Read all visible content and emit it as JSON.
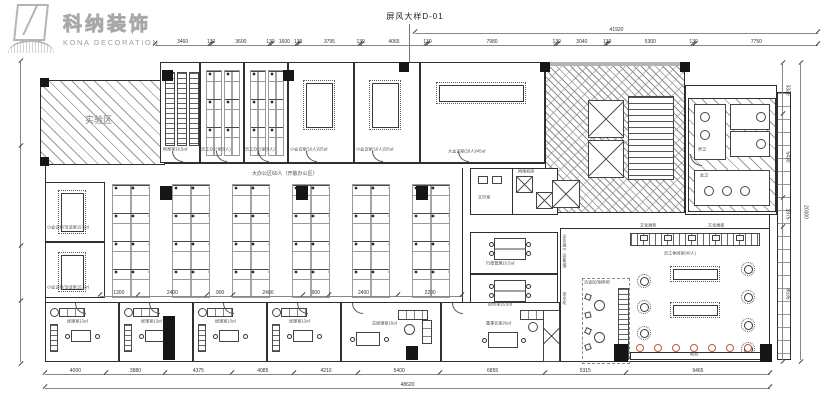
{
  "logo": {
    "cn": "科纳装饰",
    "en": "KONA DECORATION"
  },
  "title": "屏风大样D-01",
  "colors": {
    "stool_accent": "#c2573b",
    "logo_gray": "#b5b5b5",
    "line": "#2f2f2f"
  },
  "dims": {
    "top": [
      "3460",
      "130",
      "3600",
      "130",
      "1600",
      "130",
      "3795",
      "130",
      "4065",
      "130",
      "7980",
      "130",
      "3040",
      "130",
      "5300",
      "130",
      "7750"
    ],
    "top_overall": "41920",
    "bottom": [
      "4000",
      "3880",
      "4375",
      "4085",
      "4210",
      "5400",
      "6855",
      "5315",
      "9465"
    ],
    "bottom_overall": "48620",
    "right": [
      "3320",
      "5430",
      "1875",
      "8535"
    ],
    "right_overall": "20300",
    "office_inner": [
      "1300",
      "2400",
      "900",
      "2400",
      "900",
      "2400",
      "2200"
    ]
  },
  "rooms": {
    "lab": "实验区",
    "archive": "档案室16.5㎡",
    "staff_a": "员工办公室(8人)",
    "staff_b": "员工办公室(8人)",
    "meeting_a": "小会议室(10人)/25㎡",
    "meeting_b": "小会议室(10人)/25㎡",
    "conference": "大会议室(18人)/45㎡",
    "open_office": "大办公区60人（开敞办公区）",
    "left_meeting_1": "小会议室/洽谈室15.5㎡",
    "left_meeting_2": "小会议室/洽谈室15.5㎡",
    "print": "文印室",
    "server": "网络机房",
    "admin": "行政管理16.5㎡",
    "finance": "财务室16.5㎡",
    "brand_wall": "企业展示（形象墙）",
    "tea": "茶水柜",
    "manager": "经理室13㎡",
    "gm": "总经理室18㎡",
    "chairman": "董事长室26㎡",
    "lounge": "员工休闲室(40人)",
    "display_cabinet": "文化展柜",
    "display_board": "文化展板",
    "cafe": "洽谈区/咖啡吧",
    "bar": "吧台",
    "wc_men": "男卫",
    "wc_women": "女卫"
  }
}
